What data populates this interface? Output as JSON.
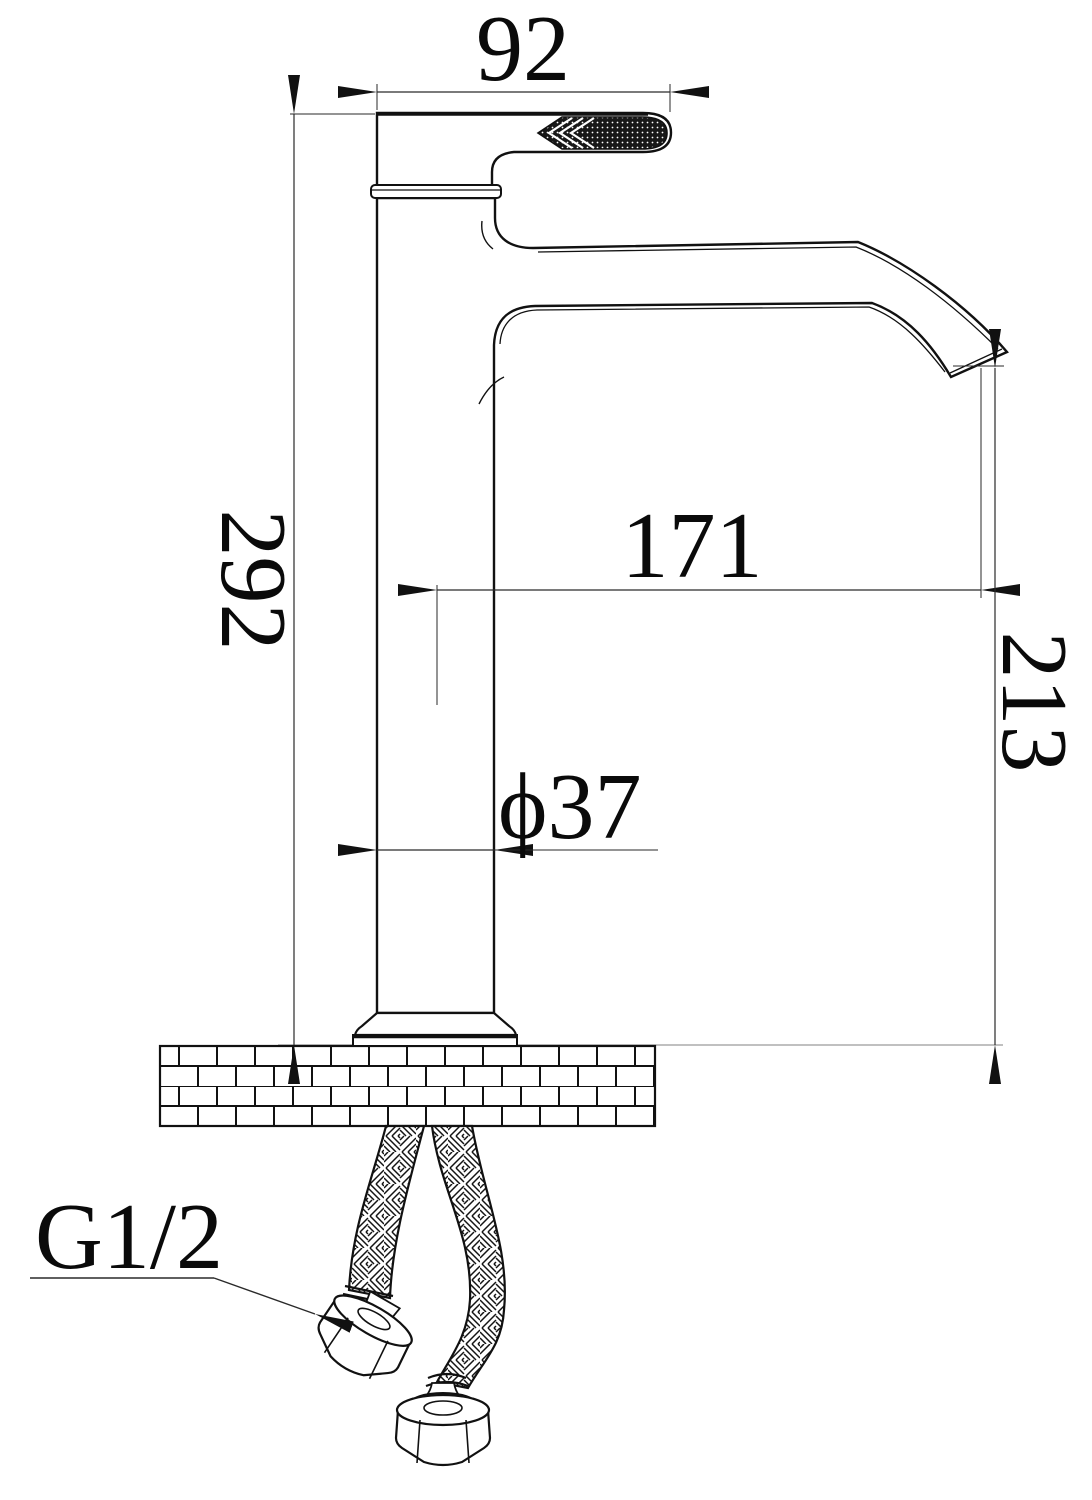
{
  "dims": {
    "top_width": "92",
    "overall_height": "292",
    "spout_reach": "171",
    "spout_outlet_height": "213",
    "body_diameter": "ϕ37",
    "connection_thread": "G1/2"
  },
  "colors": {
    "background": "#ffffff",
    "outline": "#111111",
    "dim_line": "#2a2a2a",
    "surface_line": "#9a9a9a",
    "text": "#0a0a0a"
  }
}
